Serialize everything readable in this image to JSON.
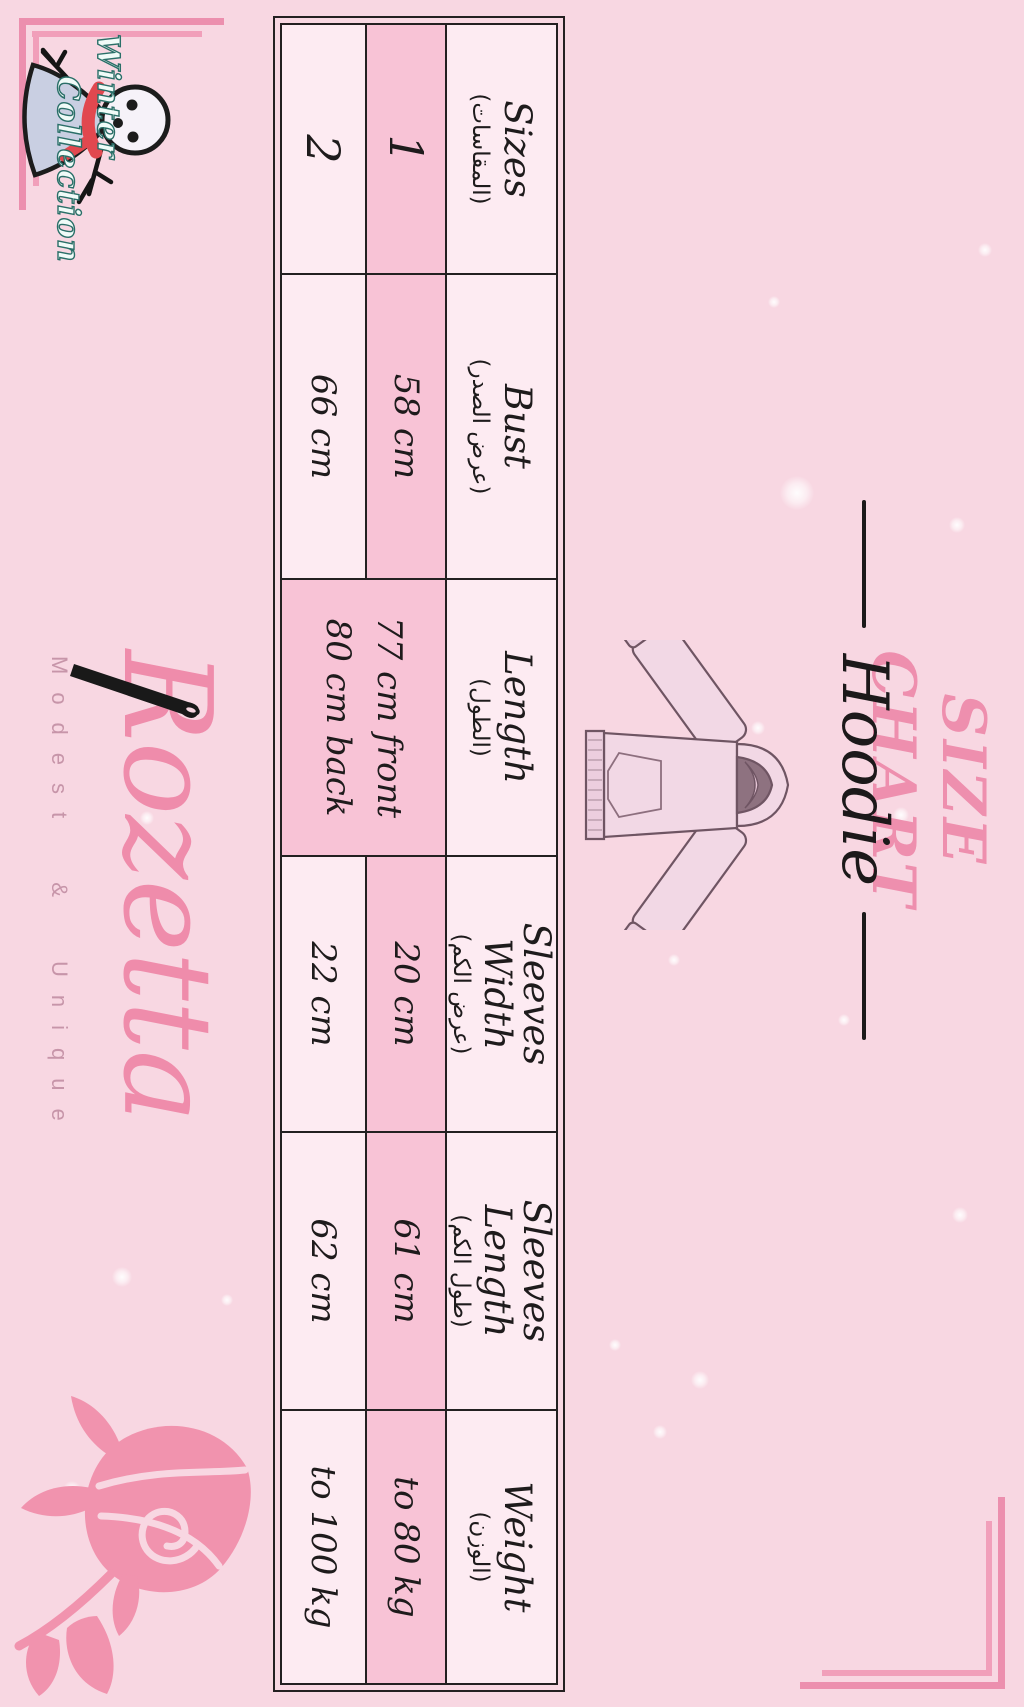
{
  "page": {
    "background": "#f8d7e2",
    "cell_bg": "#fdebf2",
    "highlight_bg": "#f8c3d6",
    "border_color": "#232021",
    "accent_pink": "#ee8fae"
  },
  "title": {
    "text": "SIZE CHART"
  },
  "product": {
    "name": "Hoodie"
  },
  "size_table": {
    "columns": [
      {
        "header_lines": [
          "Sizes"
        ],
        "header_ar": "(المقاسات)",
        "values": [
          "1",
          "2"
        ]
      },
      {
        "header_lines": [
          "Bust"
        ],
        "header_ar": "(عرض الصدر)",
        "values": [
          "58 cm",
          "66 cm"
        ]
      },
      {
        "header_lines": [
          "Length"
        ],
        "header_ar": "(الطول)",
        "merged_value_lines": [
          "77 cm front",
          "80 cm back"
        ]
      },
      {
        "header_lines": [
          "Sleeves",
          "Width"
        ],
        "header_ar": "(عرض الكم)",
        "values": [
          "20 cm",
          "22 cm"
        ]
      },
      {
        "header_lines": [
          "Sleeves",
          "Length"
        ],
        "header_ar": "(طول الكم)",
        "values": [
          "61 cm",
          "62 cm"
        ]
      },
      {
        "header_lines": [
          "Weight"
        ],
        "header_ar": "(الوزن)",
        "values": [
          "to 80 kg",
          "to 100 kg"
        ]
      }
    ]
  },
  "brand": {
    "name": "Rozetta",
    "tagline": "Modest & Unique"
  },
  "collection_badge": {
    "line1": "Winter",
    "line2": "Collection"
  }
}
